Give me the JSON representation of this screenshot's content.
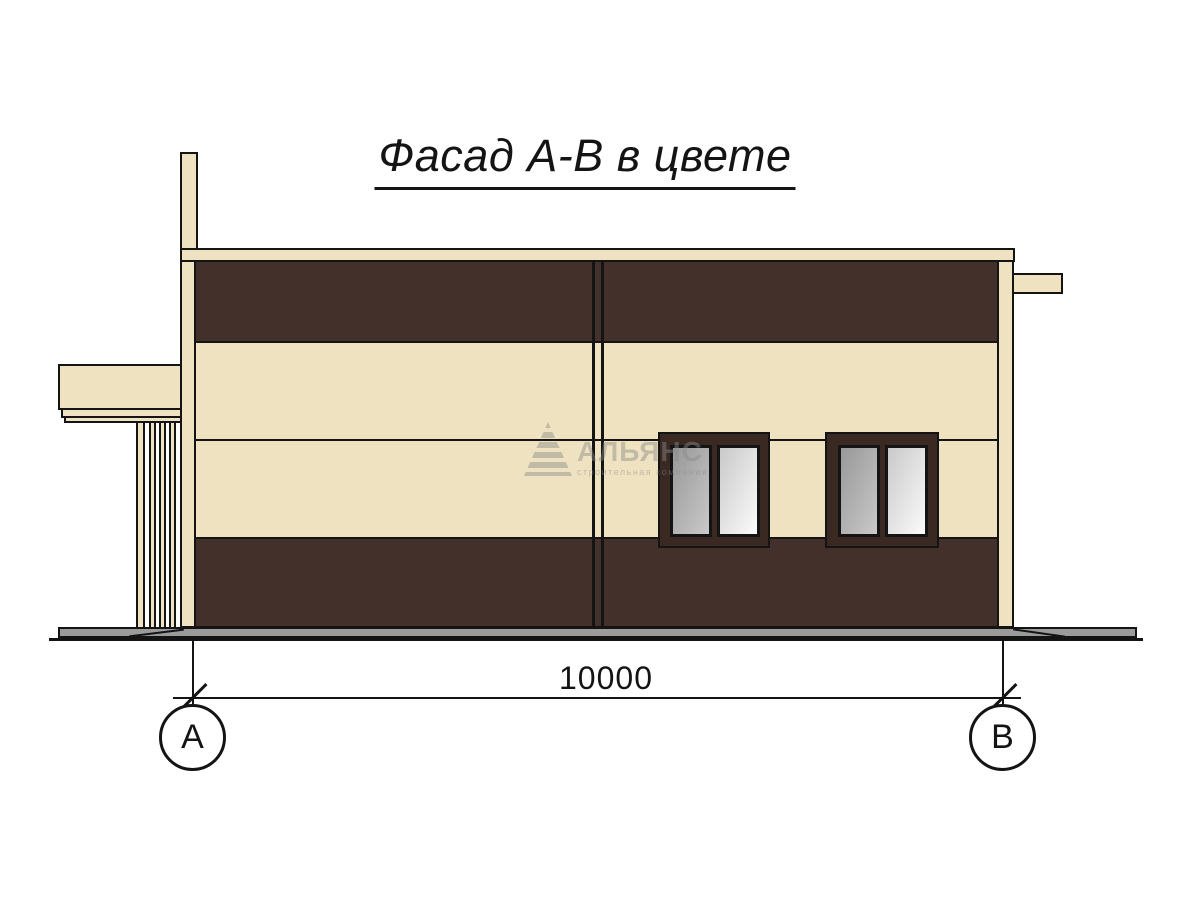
{
  "drawing": {
    "title": "Фасад А-В в цвете",
    "dimension_label": "10000",
    "axis_left": "А",
    "axis_right": "В"
  },
  "watermark": {
    "name": "АЛЬЯНС",
    "tagline": "строительная компания"
  },
  "colors": {
    "cream": "#EEE2C0",
    "brown": "#44302A",
    "frame-brown": "#3A2922",
    "ground-gray": "#9B9B9B",
    "ink": "#141414",
    "glass-dark": "#989898",
    "glass-mid": "#C9C9C9",
    "glass-light": "#FBFBFB",
    "watermark-gray": "#8A8A8A"
  }
}
